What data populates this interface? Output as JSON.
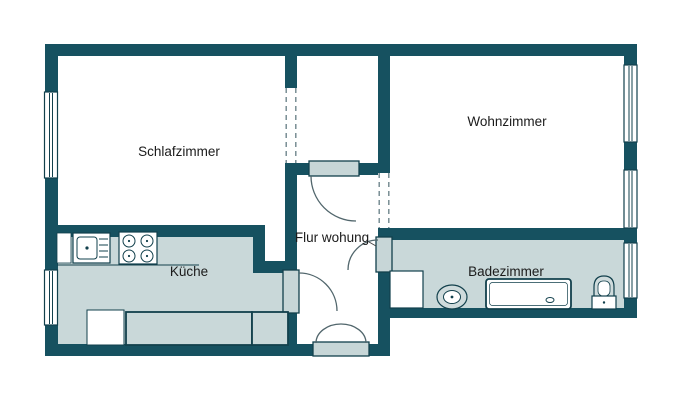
{
  "rooms": {
    "schlafzimmer": {
      "label": "Schlafzimmer"
    },
    "wohnzimmer": {
      "label": "Wohnzimmer"
    },
    "kueche": {
      "label": "Küche"
    },
    "flur": {
      "label": "Flur wohung"
    },
    "badezimmer": {
      "label": "Badezimmer"
    }
  },
  "fixtures": {
    "kitchen": [
      "dishwasher-unit",
      "kitchen-sink",
      "kitchen-stove",
      "refrigerator",
      "kitchen-counter",
      "kitchen-counter-small"
    ],
    "bathroom": [
      "washing-machine",
      "bathroom-sink",
      "bathtub",
      "toilet"
    ]
  },
  "colors": {
    "wall": "#165160",
    "floor": "#c9d8d9",
    "threshold": "#c7d6d7",
    "outline": "#12404c",
    "dash": "#6f868c",
    "arc": "#51666c",
    "text": "#1b1b1b",
    "fixture_gray": "#cfdbdc"
  }
}
